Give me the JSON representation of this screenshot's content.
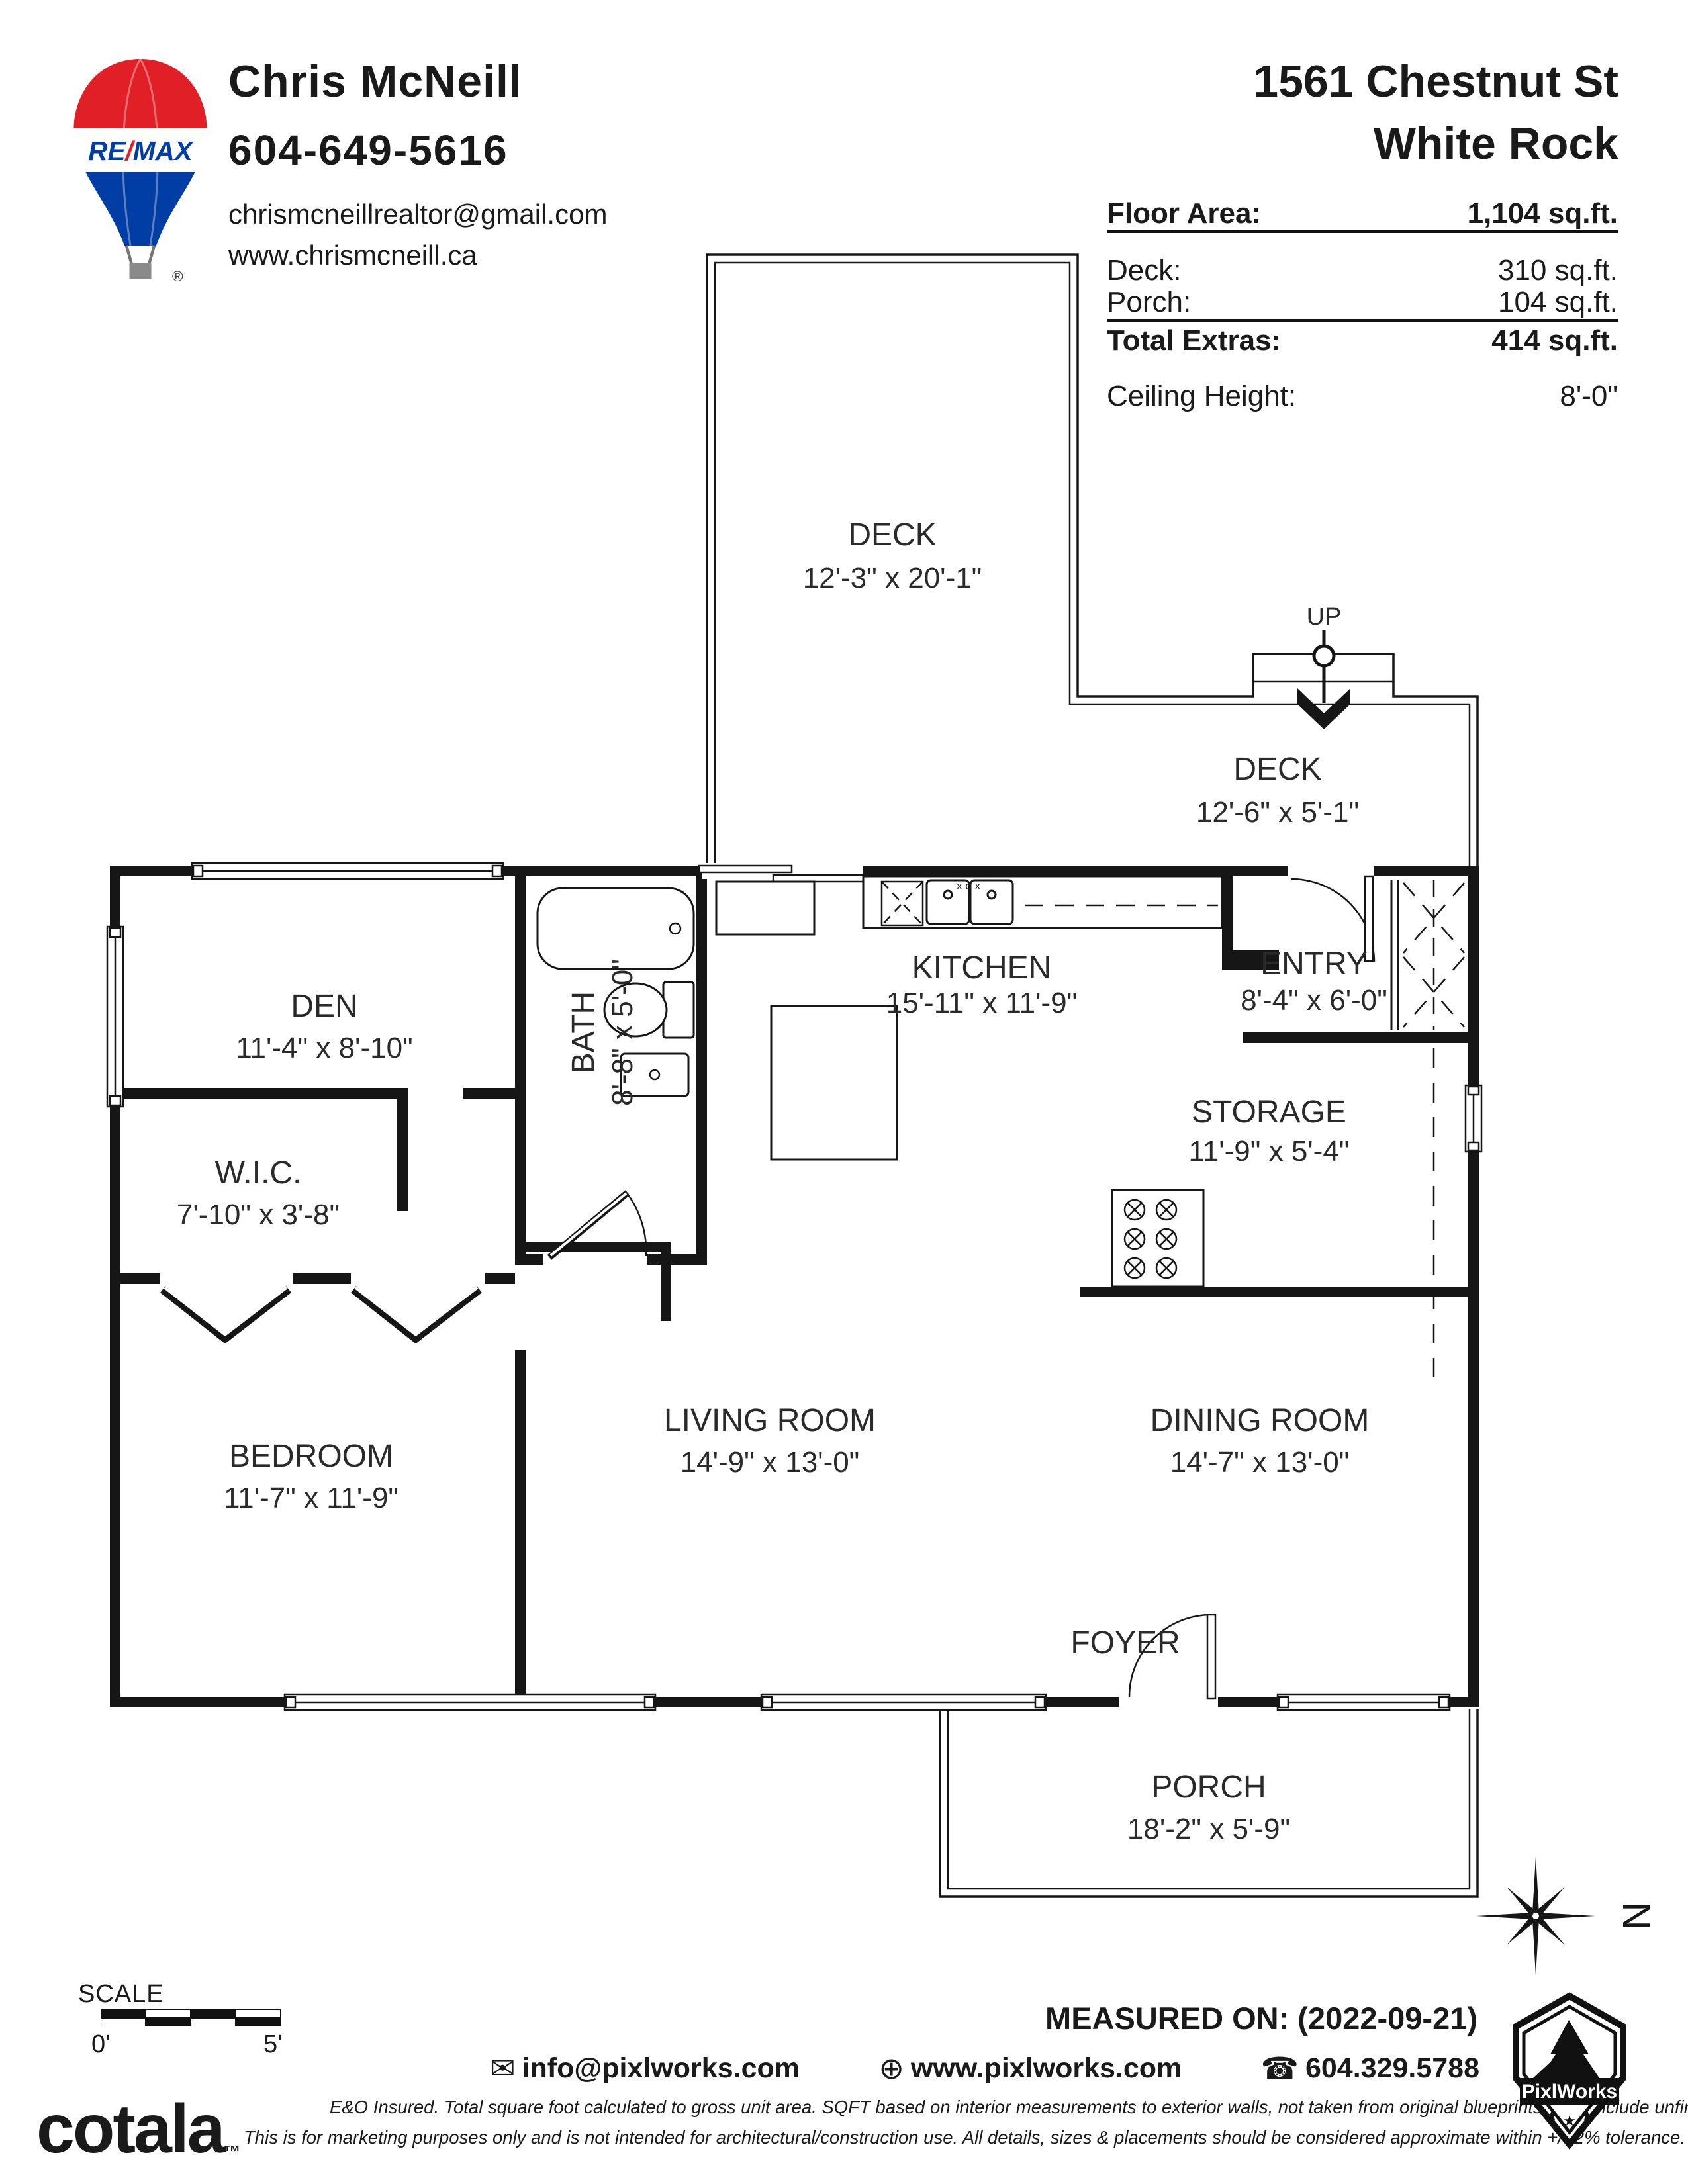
{
  "header": {
    "logo": {
      "brand_re": "RE",
      "brand_slash": "/",
      "brand_max": "MAX",
      "registered": "®"
    },
    "agent": {
      "name": "Chris McNeill",
      "phone": "604-649-5616",
      "email": "chrismcneillrealtor@gmail.com",
      "website": "www.chrismcneill.ca"
    },
    "address_line1": "1561 Chestnut St",
    "address_line2": "White Rock",
    "stats": {
      "floor_area_label": "Floor Area:",
      "floor_area_value": "1,104 sq.ft.",
      "deck_label": "Deck:",
      "deck_value": "310 sq.ft.",
      "porch_label": "Porch:",
      "porch_value": "104 sq.ft.",
      "total_extras_label": "Total Extras:",
      "total_extras_value": "414 sq.ft.",
      "ceiling_label": "Ceiling Height:",
      "ceiling_value": "8'-0\""
    }
  },
  "plan": {
    "rooms": [
      {
        "id": "deck-upper",
        "name": "DECK",
        "dims": "12'-3\" x 20'-1\""
      },
      {
        "id": "deck-lower",
        "name": "DECK",
        "dims": "12'-6\" x  5'-1\""
      },
      {
        "id": "den",
        "name": "DEN",
        "dims": "11'-4\" x 8'-10\""
      },
      {
        "id": "bath",
        "name": "BATH",
        "dims": "8'-8\" x 5'-0\""
      },
      {
        "id": "wic",
        "name": "W.I.C.",
        "dims": "7'-10\" x 3'-8\""
      },
      {
        "id": "kitchen",
        "name": "KITCHEN",
        "dims": "15'-11\" x 11'-9\""
      },
      {
        "id": "entry",
        "name": "ENTRY",
        "dims": "8'-4\" x 6'-0\""
      },
      {
        "id": "storage",
        "name": "STORAGE",
        "dims": "11'-9\" x 5'-4\""
      },
      {
        "id": "bedroom",
        "name": "BEDROOM",
        "dims": "11'-7\" x 11'-9\""
      },
      {
        "id": "living",
        "name": "LIVING ROOM",
        "dims": "14'-9\" x 13'-0\""
      },
      {
        "id": "dining",
        "name": "DINING ROOM",
        "dims": "14'-7\" x 13'-0\""
      },
      {
        "id": "porch",
        "name": "PORCH",
        "dims": "18'-2\" x 5'-9\""
      }
    ],
    "labels": {
      "up": "UP",
      "foyer": "FOYER",
      "sink_marks": "x o x"
    },
    "compass_north": "N"
  },
  "footer": {
    "scale_label": "SCALE",
    "scale_zero": "0'",
    "scale_five": "5'",
    "brand": "cotala",
    "brand_tm": "™",
    "measured_on": "MEASURED ON: (2022-09-21)",
    "contact": {
      "email": "info@pixlworks.com",
      "website": "www.pixlworks.com",
      "phone": "604.329.5788"
    },
    "disclaimer_line1": "E&O Insured.  Total square foot calculated to gross unit area. SQFT based on interior measurements to exterior walls, not taken from original blueprints, may include unfinished area.",
    "disclaimer_line2": "This is for marketing purposes only and is not intended for architectural/construction use.  All details, sizes & placements should be considered approximate within +/- 2%  tolerance.",
    "pixlworks": "PixlWorks"
  },
  "colors": {
    "ink": "#161616",
    "remax_red": "#e01f26",
    "remax_blue": "#003da5"
  }
}
